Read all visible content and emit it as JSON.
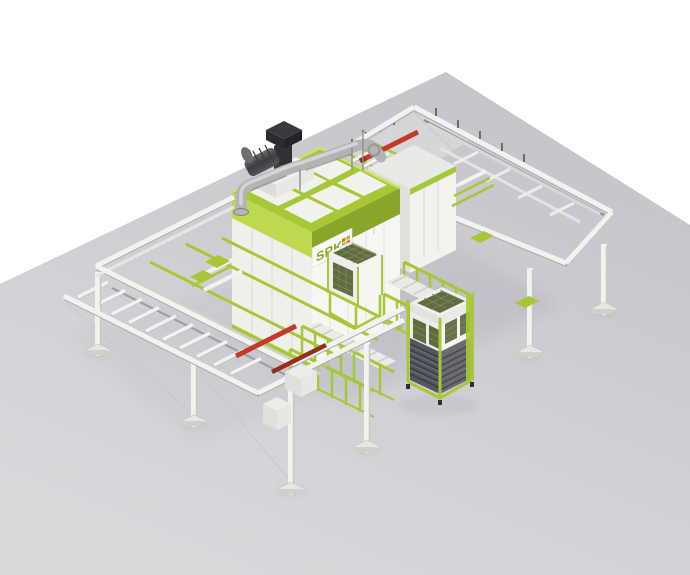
{
  "window": {
    "background": "#ffffff"
  },
  "logo": {
    "text": "SPK",
    "squares": [
      "#e07b1f",
      "#9fc23a",
      "#9fc23a",
      "#e07b1f"
    ]
  },
  "colors": {
    "lime": "#a6c836",
    "lime-light": "#bcd94f",
    "lime-pale": "#cbe463",
    "lime-dark": "#8aa62a",
    "lime-deep": "#7e992a",
    "panel": "#f2f2ef",
    "panel-shade": "#e3e3df",
    "panel-dark": "#d2d2ce",
    "steel-light": "#d7d7d9",
    "steel": "#b4b4b7",
    "steel-dark": "#8b8b8f",
    "charcoal": "#3b3b40",
    "charcoal-dark": "#26262b",
    "louver": "#55575e",
    "louver-light": "#72747b",
    "mesh": "#5f6b41",
    "mesh-light": "#7b8a55",
    "red": "#c5392a",
    "red-dark": "#992c1c",
    "floor-top": "#c5c6cc",
    "floor-bottom": "#dadadd",
    "shadow": "#aeafb8",
    "wire": "#c6c7cb",
    "plate": "#fafaf8"
  },
  "components": [
    "floor",
    "infeed-conveyor",
    "outfeed-gantry",
    "machine-rear-unit",
    "blast-machine",
    "filter-cabinet-small",
    "filter-cabinet-large",
    "safety-fences",
    "roller-tables",
    "side-gantry"
  ]
}
